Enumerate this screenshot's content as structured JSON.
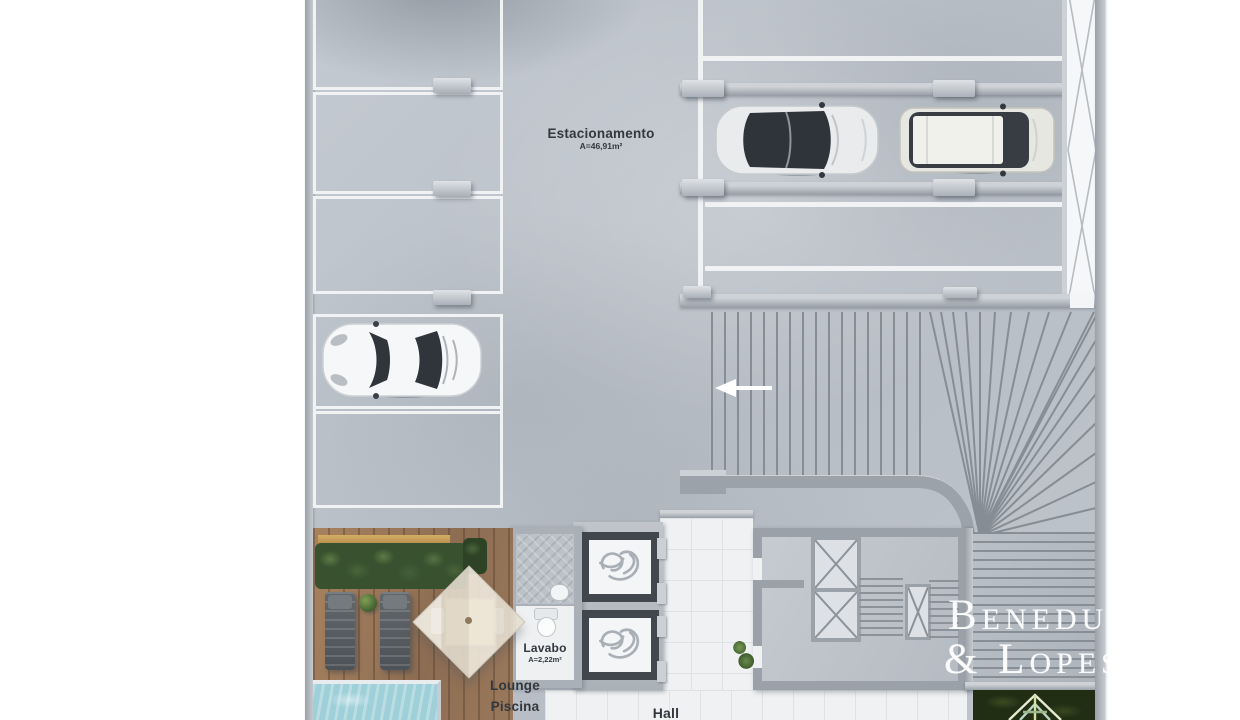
{
  "plan": {
    "type": "architectural-floor-plan",
    "labels": {
      "estacionamento": {
        "title": "Estacionamento",
        "area": "A=46,91m²"
      },
      "lavabo": {
        "title": "Lavabo",
        "area": "A=2,22m²"
      },
      "lounge": {
        "line1": "Lounge",
        "line2": "Piscina"
      },
      "hall": "Hall"
    },
    "watermark": {
      "line1": "Beneduzi",
      "line2": "& Lopes"
    },
    "colors": {
      "concrete": "#bcc2c9",
      "wall": "#9aa1a8",
      "parking_line": "#f0f2f4",
      "deck_wood": "#98755a",
      "pool_water": "#a9d7df",
      "hedge_green": "#3a5230",
      "garden_green": "#232f15",
      "elevator_frame": "#42474d",
      "label_text": "#33383e",
      "watermark_text": "#ffffff"
    }
  }
}
